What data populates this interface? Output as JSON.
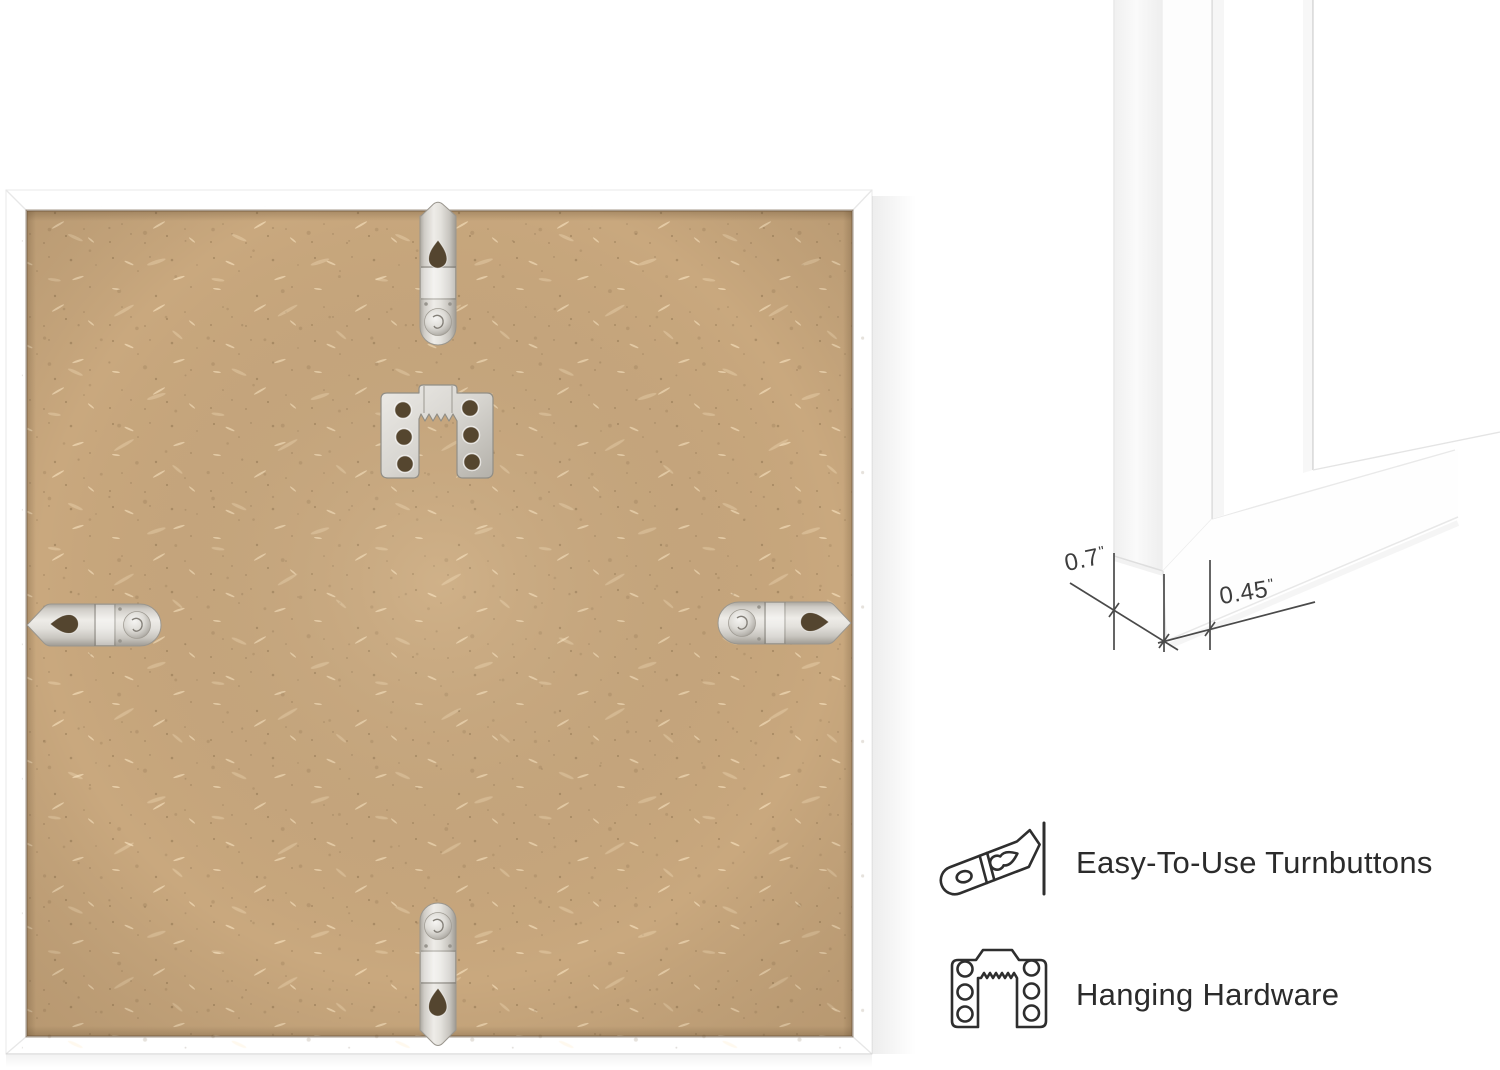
{
  "canvas": {
    "width": 1500,
    "height": 1070,
    "background": "#ffffff"
  },
  "photo": {
    "board_color": "#c9a87e",
    "frame_color": "#ffffff",
    "hardware_names": [
      "turnbutton-top",
      "sawtooth-hanger",
      "turnbutton-left",
      "turnbutton-right",
      "turnbutton-bottom"
    ]
  },
  "corner_detail": {
    "depth_dimension": {
      "value": "0.7",
      "unit": "\""
    },
    "face_dimension": {
      "value": "0.45",
      "unit": "\""
    }
  },
  "features": [
    {
      "icon": "turnbutton-icon",
      "label": "Easy-To-Use Turnbuttons"
    },
    {
      "icon": "hanging-hardware-icon",
      "label": "Hanging Hardware"
    }
  ]
}
